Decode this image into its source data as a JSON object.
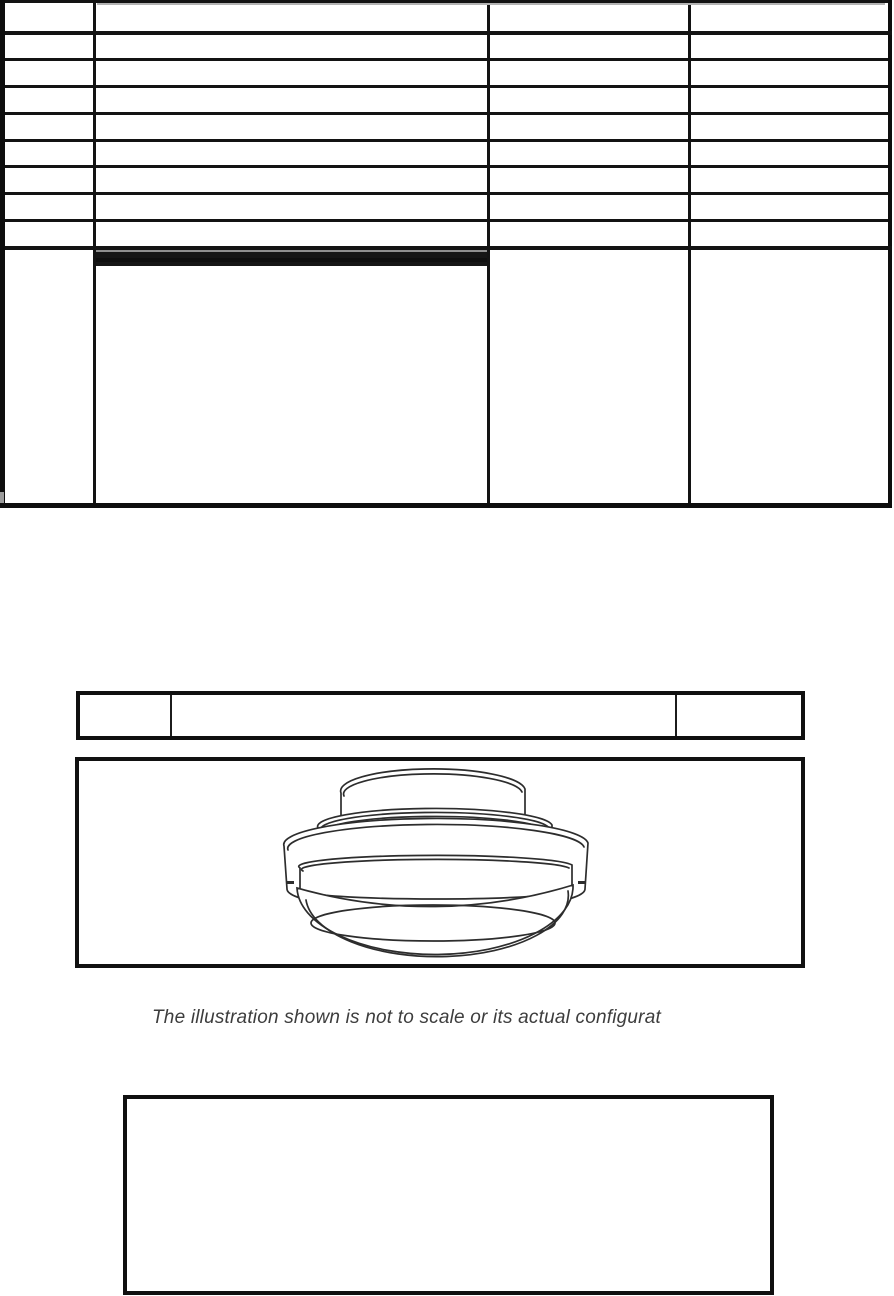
{
  "caption": {
    "text": "The illustration shown is not to scale or its actual configurat"
  },
  "figure": {
    "label": "ceiling-mount dome device line drawing"
  },
  "colors": {
    "table_border": "#0e0e0e",
    "grid_line": "#131313",
    "gray_separator": "#8f8f8f",
    "scan_artifact_gray": "#b3b3b3",
    "drawing_stroke": "#2d2d2d",
    "caption_text": "#3d3d3d",
    "page_background": "#ffffff"
  }
}
